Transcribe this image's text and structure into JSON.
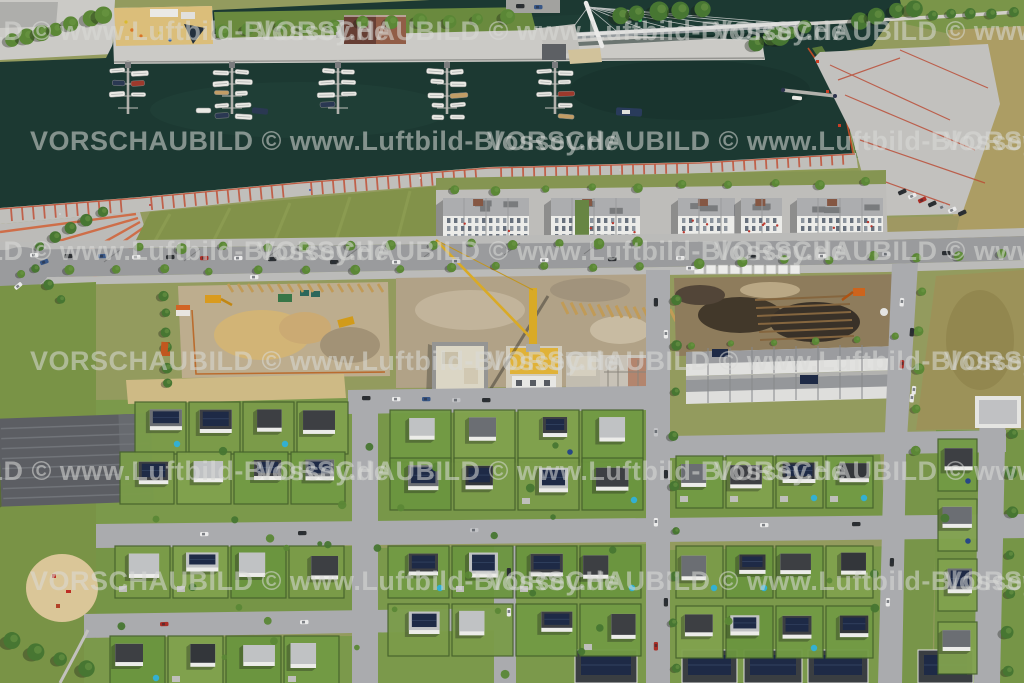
{
  "watermark": {
    "text": "VORSCHAUBILD © www.Luftbild-Blossey.de",
    "color": "#dadbd8",
    "opacity": 0.55,
    "font_size": 27,
    "row_ys": [
      33,
      143,
      253,
      363,
      473,
      583
    ],
    "even_row_x_starts": [
      -200,
      257,
      714
    ],
    "odd_row_x_starts": [
      30,
      487,
      944
    ]
  },
  "palette": {
    "water": "#1d3b34",
    "water_light": "#2a4f44",
    "pavement": "#d2d1cd",
    "road": "#9fa0a3",
    "grass": "#7f9e4e",
    "grass_field": "#87974d",
    "grass_dry": "#b2a368",
    "tree_dark": "#4a7a34",
    "tree_bright": "#5e8c38",
    "roof_dark": "#3f4246",
    "roof_mid": "#6f7277",
    "roof_light": "#c7c9cb",
    "wall_white": "#f4f4f1",
    "solar_panel": "#1f2c49",
    "sand": "#d5c08a",
    "dirt": "#bcab8c",
    "soil_dark": "#453a2c",
    "crane_yellow": "#e0b028",
    "promenade_red": "#c8553a",
    "accent_orange": "#d06a28",
    "pool_blue": "#35b6d9",
    "boat_white": "#f2f1ec"
  }
}
